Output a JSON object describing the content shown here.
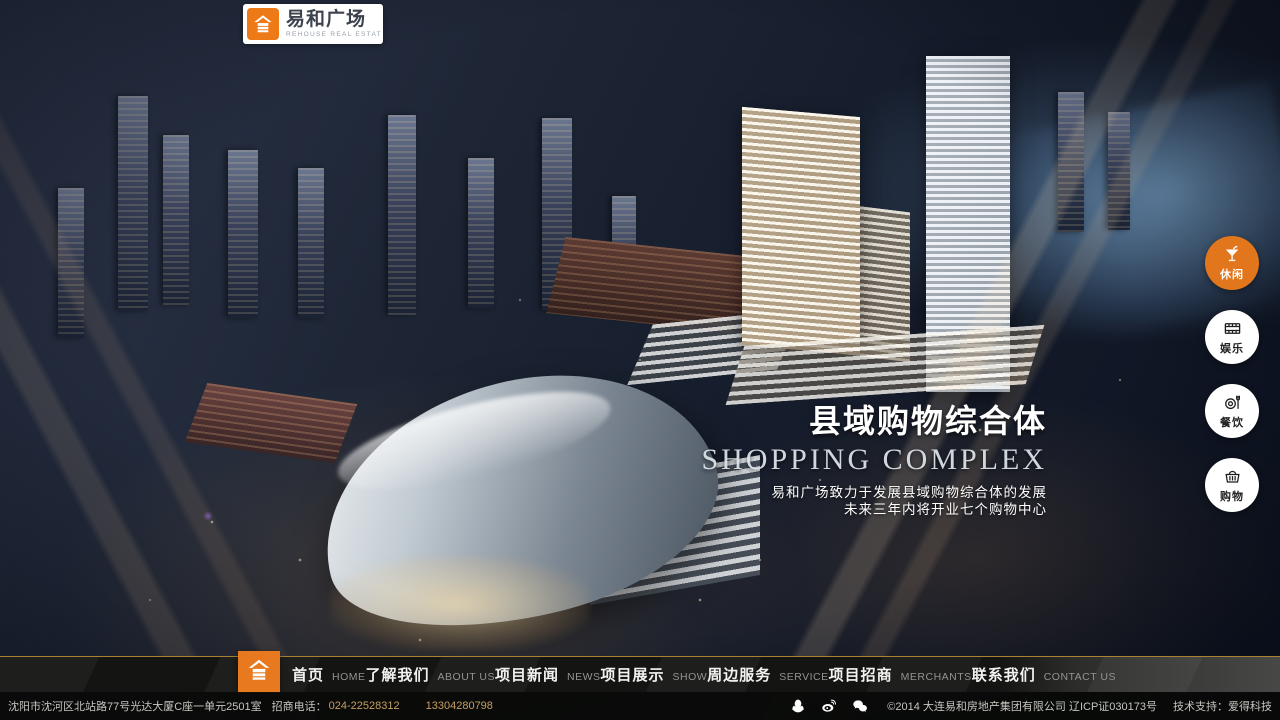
{
  "logo": {
    "brand_cn": "易和广场",
    "brand_en": "REHOUSE REAL ESTAT"
  },
  "side_buttons": {
    "items": [
      {
        "label": "休闲",
        "icon": "cocktail-icon",
        "active": true
      },
      {
        "label": "娱乐",
        "icon": "film-icon",
        "active": false
      },
      {
        "label": "餐饮",
        "icon": "dining-icon",
        "active": false
      },
      {
        "label": "购物",
        "icon": "basket-icon",
        "active": false
      }
    ]
  },
  "hero": {
    "title_cn": "县域购物综合体",
    "title_en": "SHOPPING COMPLEX",
    "subtitle_line1": "易和广场致力于发展县域购物综合体的发展",
    "subtitle_line2": "未来三年内将开业七个购物中心"
  },
  "nav": {
    "items": [
      {
        "cn": "首页",
        "en": "HOME"
      },
      {
        "cn": "了解我们",
        "en": "ABOUT US"
      },
      {
        "cn": "项目新闻",
        "en": "NEWS"
      },
      {
        "cn": "项目展示",
        "en": "SHOW"
      },
      {
        "cn": "周边服务",
        "en": "SERVICE"
      },
      {
        "cn": "项目招商",
        "en": "MERCHANTS"
      },
      {
        "cn": "联系我们",
        "en": "CONTACT US"
      }
    ]
  },
  "footer": {
    "address": "沈阳市沈河区北站路77号光达大厦C座一单元2501室",
    "phone_label": "招商电话：",
    "phone1": "024-22528312",
    "phone2": "13304280798",
    "social_icons": [
      "qq-icon",
      "weibo-icon",
      "wechat-icon"
    ],
    "copyright": "©2014 大连易和房地产集团有限公司 辽ICP证030173号",
    "tech_support": "技术支持：爱得科技"
  },
  "colors": {
    "accent_orange": "#e8791e",
    "gold_line": "#a8842e",
    "nav_bg": "#141412"
  }
}
